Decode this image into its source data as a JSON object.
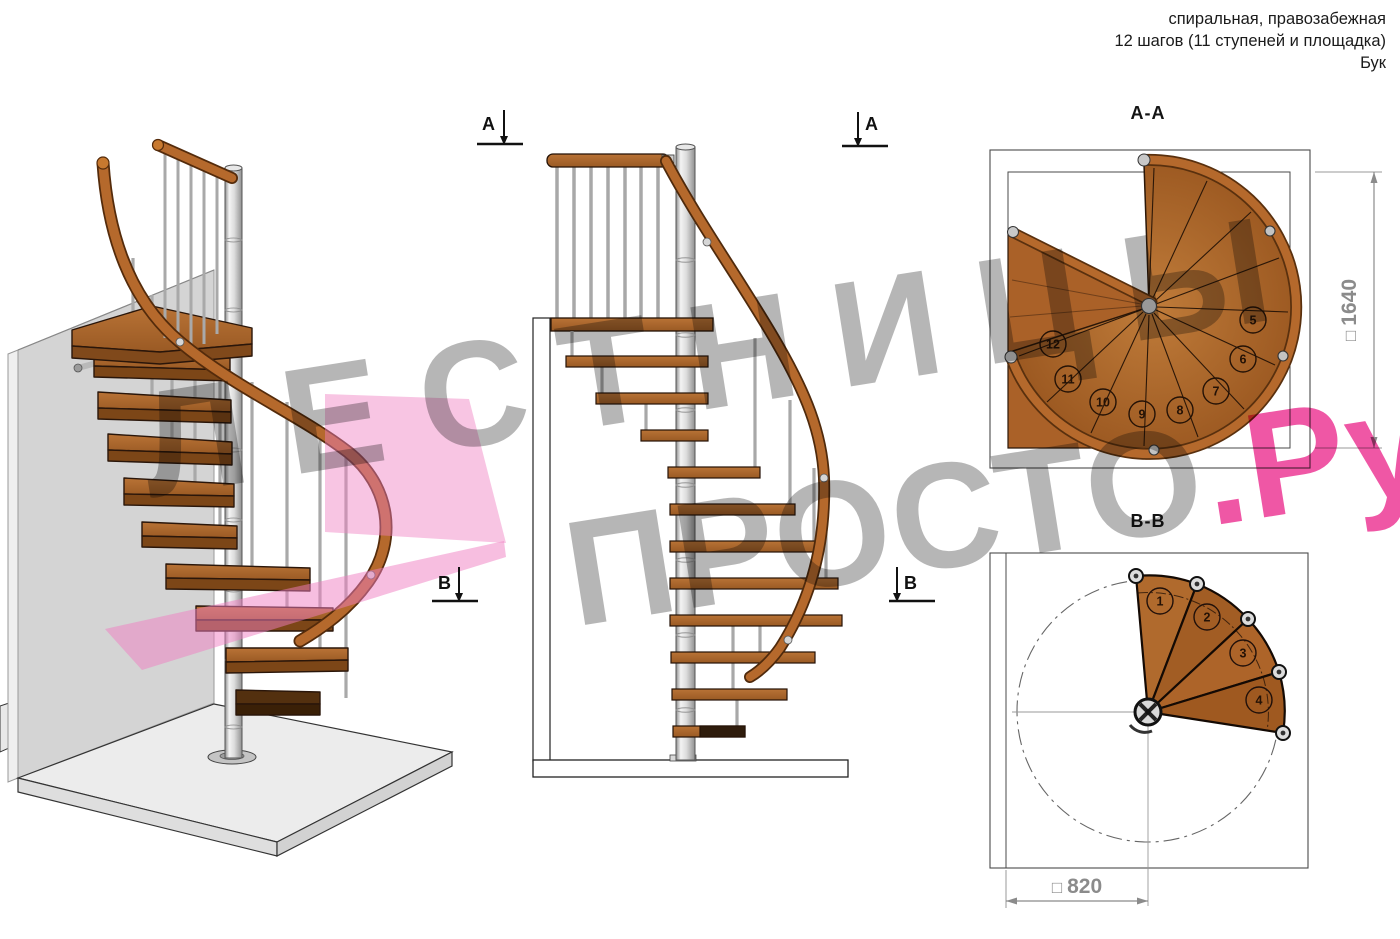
{
  "header": {
    "line1": "спиральная, правозабежная",
    "line2": "12 шагов (11 ступеней и площадка)",
    "line3": "Бук"
  },
  "watermark": {
    "line1": "ЛЕСТНИЦЫ",
    "line2_gray": "ПРОСТО",
    "line2_accent": ".Ру",
    "gray_color": "#6e6e6e",
    "accent_color": "#eb288c"
  },
  "views": {
    "elevation": {
      "marker_a": "А",
      "marker_b": "В"
    },
    "section_aa": {
      "title": "А-А",
      "step_numbers": [
        "5",
        "6",
        "7",
        "8",
        "9",
        "10",
        "11",
        "12"
      ],
      "dimension": {
        "prefix": "□",
        "value": "1640"
      }
    },
    "section_bb": {
      "title": "В-В",
      "step_numbers": [
        "1",
        "2",
        "3",
        "4"
      ],
      "dimension": {
        "prefix": "□",
        "value": "820"
      }
    }
  },
  "colors": {
    "wood": "#ab6329",
    "wood_dark": "#7c4617",
    "handrail": "#b5692c",
    "metal": "#c9c9c9",
    "section_plane_pink": "#f07ec2",
    "dimension_gray": "#8b8b8b",
    "line": "#1a1a1a"
  }
}
